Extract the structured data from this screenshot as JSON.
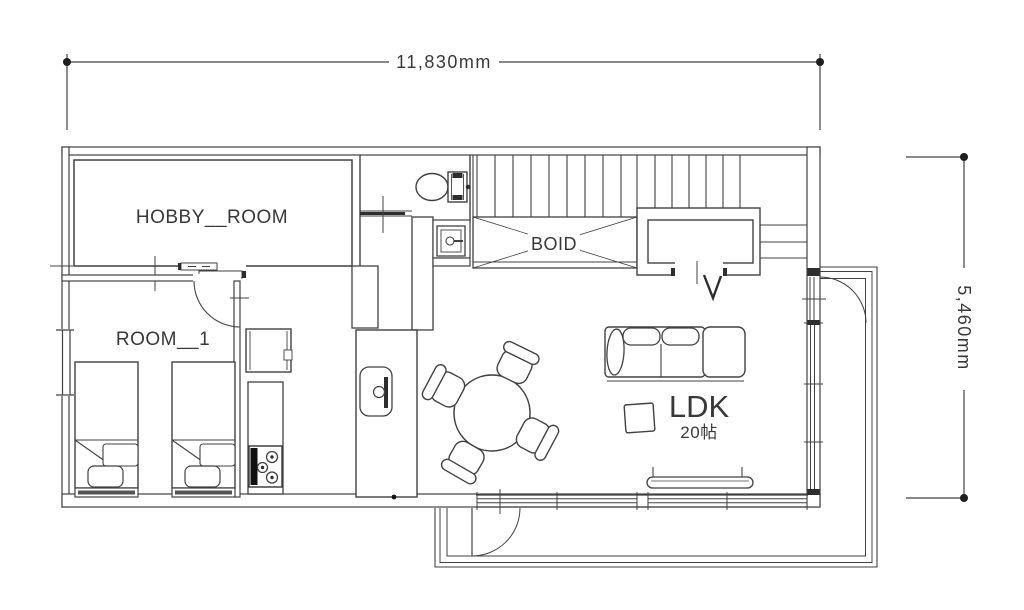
{
  "page": {
    "background": "#ffffff"
  },
  "colors": {
    "line": "#414141",
    "dark": "#1e1e1e",
    "text": "#383838"
  },
  "dimensions": {
    "width_label": "11,830mm",
    "height_label": "5,460mm"
  },
  "rooms": {
    "hobby_room": {
      "label": "HOBBY__ROOM"
    },
    "room_1": {
      "label": "ROOM__1"
    },
    "void_area": {
      "label": "BOID"
    },
    "ldk": {
      "label": "LDK",
      "size_label": "20帖"
    }
  }
}
